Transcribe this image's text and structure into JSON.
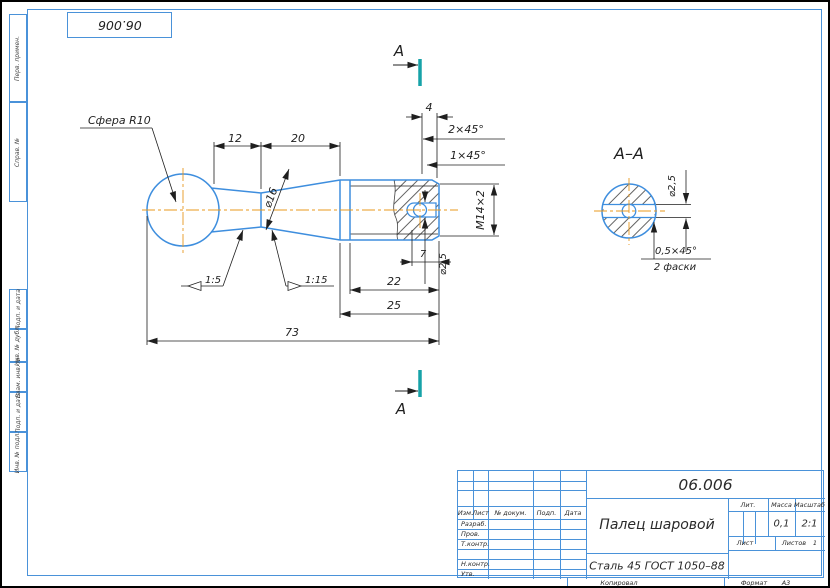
{
  "colors": {
    "outline_blue": "#3E8EDE",
    "frame_blue": "#4A92D9",
    "centerline_orange": "#E8981E",
    "section_cut_teal": "#17A2A8",
    "ink": "#1F1F1F",
    "paper": "#FFFFFF"
  },
  "frame": {
    "stamp_number": "06.006",
    "margin_fields": [
      "Перв. примен.",
      "Справ. №",
      "Подп. и дата",
      "Инв. № дубл.",
      "Взам. инв. №",
      "Подп. и дата",
      "Инв. № подл."
    ]
  },
  "drawing": {
    "sphere_label": "Сфера R10",
    "dims": {
      "neck_length": "12",
      "cone_length": "20",
      "thread_runout": "4",
      "chamfer_2": "2×45°",
      "chamfer_1": "1×45°",
      "cone_diameter": "⌀16",
      "thread": "М14×2",
      "hole_diameter": "⌀2,5",
      "hole_offset": "7",
      "thread_length": "22",
      "shank_length": "25",
      "total_length": "73",
      "taper_left": "1:5",
      "taper_right": "1:15"
    },
    "section": {
      "cut_letter": "А",
      "view_title": "А–А",
      "hole_diameter": "⌀2,5",
      "chamfer_size": "0,5×45°",
      "chamfer_count": "2 фаски"
    }
  },
  "title_block": {
    "doc_number": "06.006",
    "part_name": "Палец шаровой",
    "material": "Сталь 45  ГОСТ 1050–88",
    "change_cols": [
      "Изм.",
      "Лист",
      "№ докум.",
      "Подп.",
      "Дата"
    ],
    "sign_rows": [
      "Разраб.",
      "Пров.",
      "Т.контр.",
      "Н.контр.",
      "Утв."
    ],
    "lit_label": "Лит.",
    "mass_label": "Масса",
    "mass_value": "0,1",
    "scale_label": "Масштаб",
    "scale_value": "2:1",
    "sheet_label": "Лист",
    "sheets_label": "Листов",
    "sheets_value": "1",
    "copied_label": "Копировал",
    "format_label": "Формат",
    "format_value": "А3"
  }
}
